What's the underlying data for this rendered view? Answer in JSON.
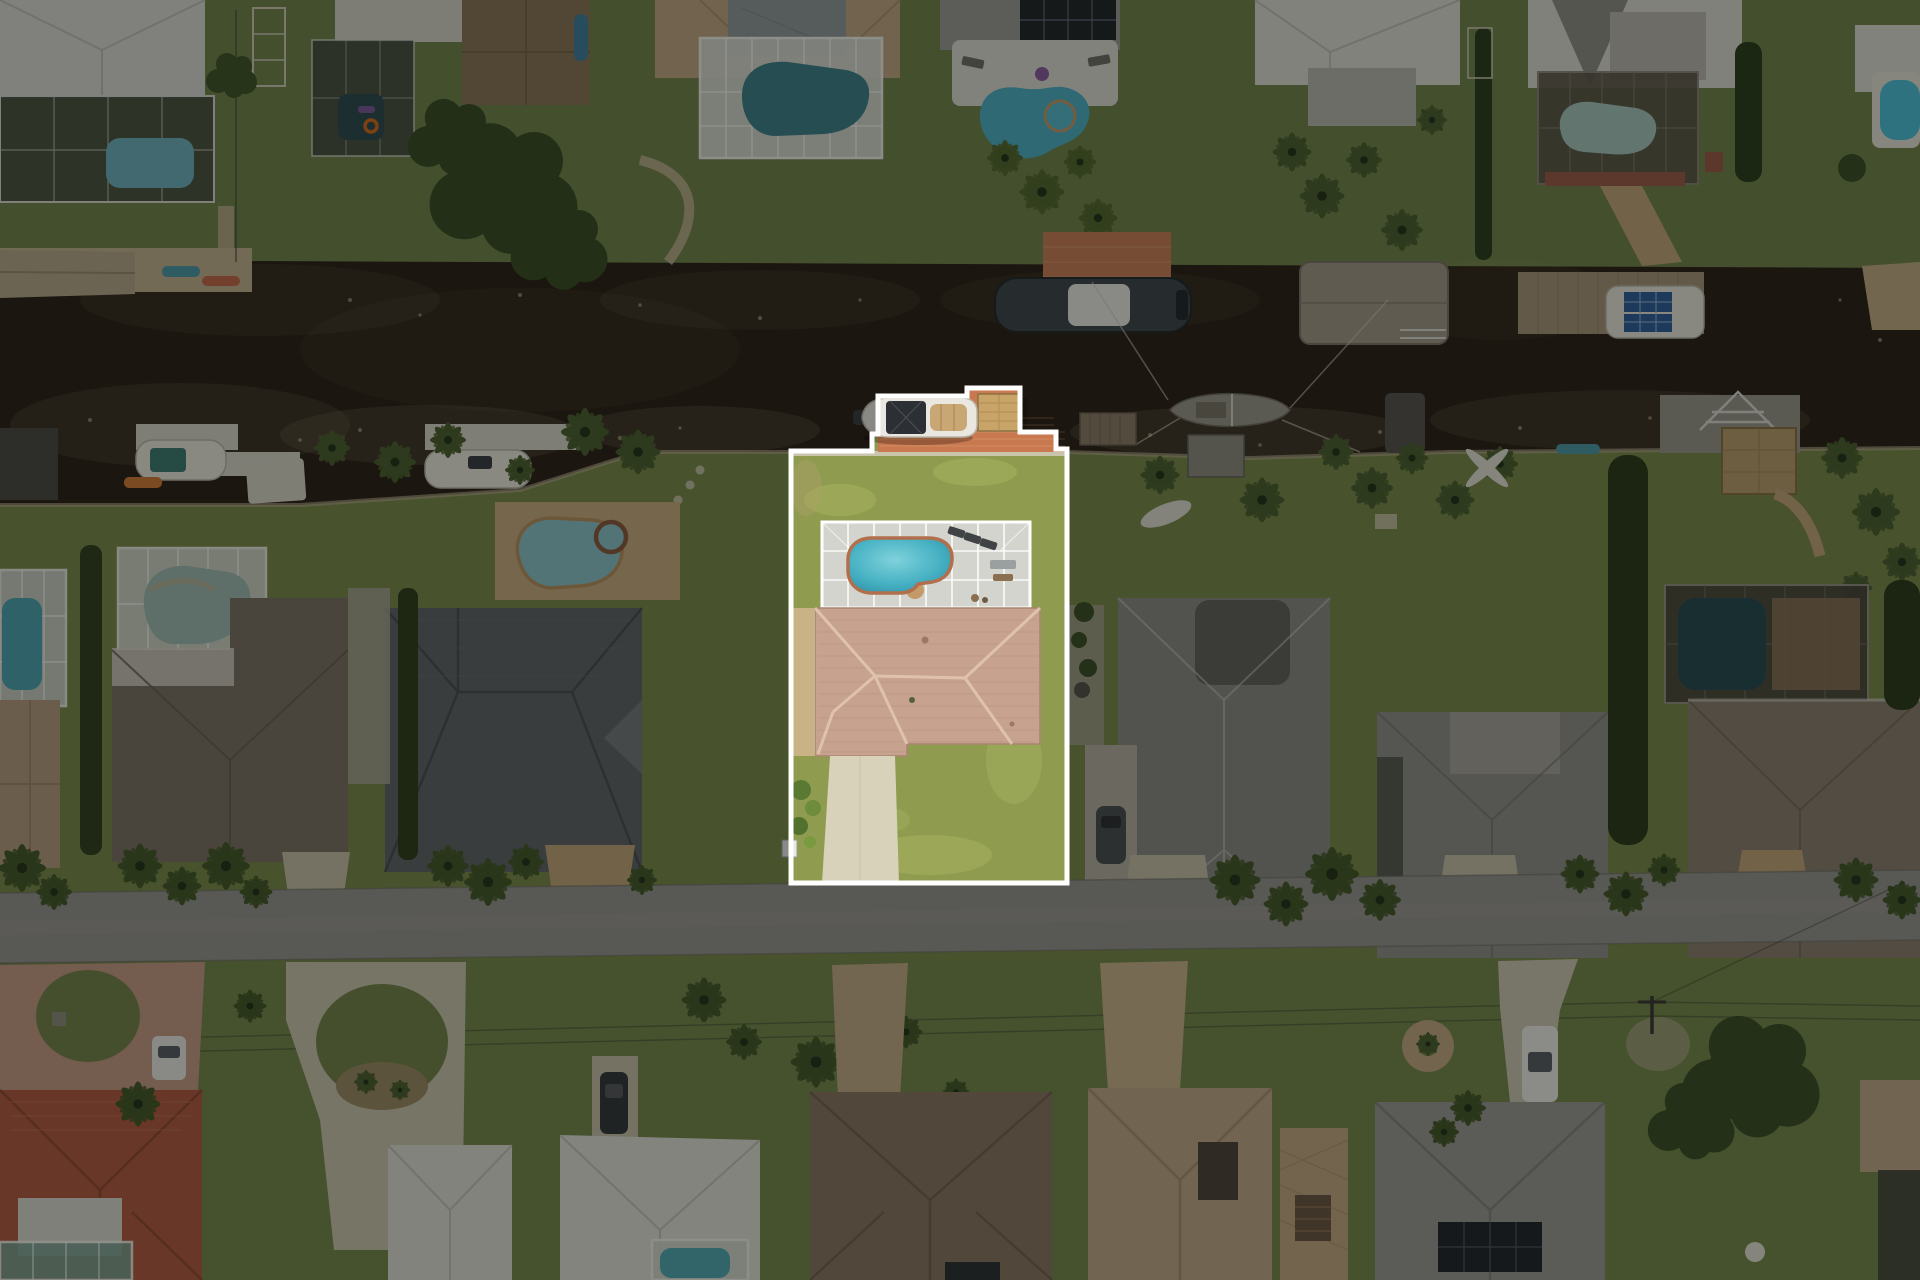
{
  "image": {
    "kind": "aerial drone photograph",
    "view": "top-down (nadir)",
    "width_px": 1920,
    "height_px": 1280,
    "visible_text": "none"
  },
  "scene": {
    "description": "Top-down drone photograph of a Florida-style waterfront residential neighborhood. A dark tannic canal lined with seawalls, docks, boat lifts and boats crosses the upper third. A gray residential street crosses the lower third. Single-family homes with tile, shingle and white metal roofs, screened pool enclosures and royal palms fill the blocks. Everything is darkened except the featured center lot, which is shown at full brightness inside a white property outline.",
    "time_of_day": "midday, high sun, minimal shadows",
    "rows": [
      "canal-front homes along the north bank",
      "canal-front homes on the south bank flanking the featured lot",
      "homes on the south side of the street"
    ]
  },
  "featured_lot": {
    "label": "featured property (highlighted listing lot)",
    "outline_color": "#ffffff",
    "outline_width_px": 5,
    "dim_overlay_outside": "rgba(0,0,0,0.42)",
    "outline_polygon_px": [
      [
        791,
        451
      ],
      [
        872,
        451
      ],
      [
        872,
        434
      ],
      [
        878,
        434
      ],
      [
        878,
        396
      ],
      [
        967,
        396
      ],
      [
        967,
        388
      ],
      [
        1020,
        388
      ],
      [
        1020,
        432
      ],
      [
        1056,
        432
      ],
      [
        1056,
        449
      ],
      [
        1067,
        449
      ],
      [
        1067,
        883
      ],
      [
        791,
        883
      ]
    ],
    "features": {
      "dock": "terracotta paver dock on the canal with boat lift",
      "boat": "white boat with dark bimini top and tan bow deck on a lift, stern motor pokes west of the property line",
      "tiki_hut": "square thatched-straw tiki hut on the dock",
      "seawall": "light concrete seawall cap along the canal edge",
      "lawn": "bright yellow-green mowed lawn",
      "pool_enclosure": "white-framed screened pool cage with light concrete deck, loungers and patio furniture",
      "pool": "kidney-shaped turquoise pool with terracotta coping",
      "house": "single-story home with pink-tan barrel-tile hip roof",
      "driveway": "light concrete driveway running south to the street",
      "landscaping": "green shrubs at the southwest corner, tan paver side strip",
      "mailbox": "small white mailbox just outside the west boundary near the street"
    }
  },
  "surroundings": {
    "canal": {
      "water_color_hex": "#2b2218",
      "notes": "very dark water with pale algae speckle along both seawalls",
      "boats": [
        "tan canopied boat lift (upper far left)",
        "white boat with teal bimini at white dock (south bank left)",
        "white runabout on lift (south bank left-center)",
        "dark-hulled boat with white T-top beside red paver dock (north bank center)",
        "white boat with blue solar panels on wooden dock (north bank right)",
        "gray sailboat moored mid-canal east of the featured lot with rigging lines to shore",
        "taupe canopy boat covers (north and south banks, right side)"
      ]
    },
    "north_bank_homes": [
      "white metal hip roof with large screened pool (far left)",
      "flat-roof home with dark screened lanai, hot tub and orange float ring",
      "brown shingle roof beside a large oak tree",
      "cream tile roof with gray sundeck and screened freeform pool",
      "gray roof with black solar array and open freeform pool with spa",
      "white metal roof with gray lanai, palms and canopied dock",
      "white metal gabled roof with bronze pool cage and paver path to dock",
      "white roof with small open bright-blue pool (far right)"
    ],
    "south_bank_homes": [
      "tan roof with white screened pool cage (far left)",
      "large brown-gray shingle roof with pale screened pool",
      "dark gray metal hip roof with tan paver deck and lagoon-style pool with spa (west neighbor)",
      "light gray shingle hip roof with dark patch and front parking pad (east neighbor)",
      "gray-taupe shingle roof behind a large open lawn",
      "brown shingle roof with long bronze screened pool cage and thatched tiki hut by the seawall (far right)"
    ],
    "street_side_homes": [
      "orange barrel-tile Spanish roof with pink circular paver driveway and white sedan",
      "two white metal roofs around a large looped concrete driveway with planted island",
      "dark SUV on a side pad",
      "large taupe tile hip roof with curved paver driveway",
      "tan tile roof with interior courtyard and long paver driveway",
      "gray shingle roof with black solar array and herringbone paver patio, white pickup in driveway",
      "tan roof with dark screened cage (far right)"
    ],
    "street_furniture": [
      "utility pole with crossarm and two long power lines angling across the lower lawns",
      "royal palm clusters along both street verges"
    ]
  },
  "palette": {
    "lawn_bright_hex": "#8f9c50",
    "lawn_dimmed_apparent_hex": "#47512c",
    "canal_water_hex": "#2b2218",
    "asphalt_street_hex": "#95938d",
    "subject_roof_tile_hex": "#c7a28e",
    "dock_paver_hex": "#c8794f",
    "pool_water_hex": "#45b0c2",
    "screen_cage_frame_hex": "#ffffff",
    "thatch_hex": "#c9a469",
    "driveway_concrete_hex": "#d8d2bb",
    "highlight_outline_hex": "#ffffff"
  }
}
